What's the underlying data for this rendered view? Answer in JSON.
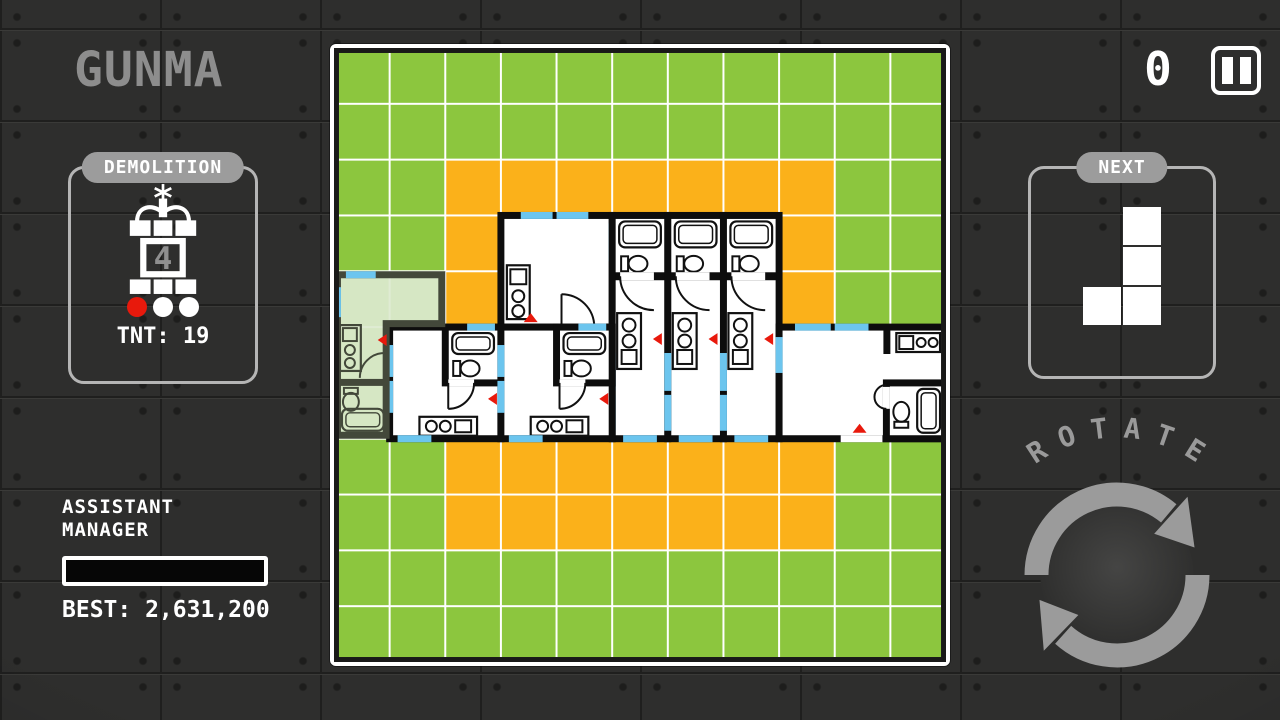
{
  "title": "GUNMA",
  "hud": {
    "score": "0",
    "demolition": {
      "label": "DEMOLITION",
      "bomb_count": "4",
      "dots": [
        "#e8190c",
        "#ffffff",
        "#ffffff"
      ],
      "tnt_label": "TNT: 19"
    },
    "assistant": {
      "line1": "ASSISTANT",
      "line2": "MANAGER",
      "progress_percent": 0,
      "best_label": "BEST: 2,631,200"
    },
    "next": {
      "label": "NEXT",
      "piece_cells": [
        [
          1,
          0
        ],
        [
          1,
          1
        ],
        [
          0,
          2
        ],
        [
          1,
          2
        ]
      ]
    },
    "rotate": {
      "label": "ROTATE",
      "letters": [
        "R",
        "O",
        "T",
        "A",
        "T",
        "E"
      ]
    }
  },
  "board": {
    "cols": 11,
    "rows": 11,
    "colors": {
      "grass": "#8cc63e",
      "plot": "#fbb11a",
      "grid": "#ffffff",
      "wall": "#0d0d0d",
      "window": "#6cc5ee",
      "arrow": "#e8190c",
      "room": "#ffffff",
      "fixture": "#111111",
      "ghost_fill": "#dce9cf",
      "ghost_wall": "#43483a"
    },
    "plot_cells": [
      [
        2,
        2
      ],
      [
        3,
        2
      ],
      [
        4,
        2
      ],
      [
        5,
        2
      ],
      [
        6,
        2
      ],
      [
        7,
        2
      ],
      [
        8,
        2
      ],
      [
        2,
        3
      ],
      [
        8,
        3
      ],
      [
        2,
        4
      ],
      [
        8,
        4
      ],
      [
        2,
        7
      ],
      [
        3,
        7
      ],
      [
        4,
        7
      ],
      [
        5,
        7
      ],
      [
        6,
        7
      ],
      [
        7,
        7
      ],
      [
        8,
        7
      ],
      [
        2,
        8
      ],
      [
        3,
        8
      ],
      [
        4,
        8
      ],
      [
        5,
        8
      ],
      [
        6,
        8
      ],
      [
        7,
        8
      ],
      [
        8,
        8
      ]
    ],
    "units": [
      {
        "type": "big-room",
        "col": 3,
        "row": 3,
        "name": "studio-apartment-unit"
      },
      {
        "type": "micro",
        "col": 5,
        "row": 3,
        "name": "micro-apartment-unit"
      },
      {
        "type": "micro",
        "col": 6,
        "row": 3,
        "name": "micro-apartment-unit"
      },
      {
        "type": "micro",
        "col": 7,
        "row": 3,
        "name": "micro-apartment-unit"
      },
      {
        "type": "flat",
        "col": 1,
        "row": 5,
        "name": "flat-apartment-unit"
      },
      {
        "type": "flat",
        "col": 3,
        "row": 5,
        "name": "flat-apartment-unit"
      },
      {
        "type": "wide",
        "col": 8,
        "row": 5,
        "name": "wide-apartment-unit"
      },
      {
        "type": "ghost",
        "col": 0,
        "row": 4,
        "name": "current-piece-apartment"
      }
    ]
  }
}
